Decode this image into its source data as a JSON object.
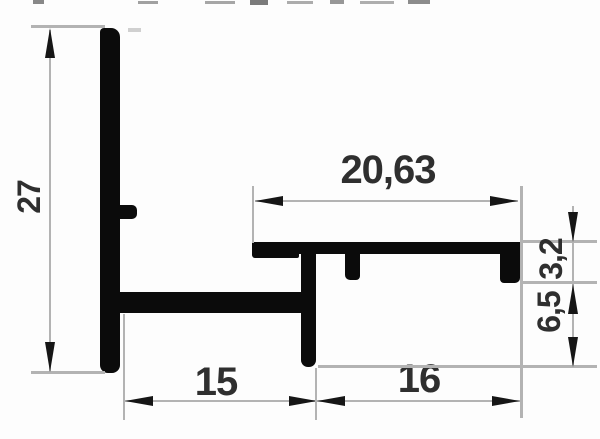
{
  "drawing": {
    "kind": "profile-cross-section-technical-drawing",
    "labels": {
      "height": "27",
      "top_width": "20,63",
      "flange_height": "3,2",
      "channel_depth": "6,5",
      "bottom_left_width": "15",
      "bottom_right_width": "16"
    },
    "colors": {
      "background": "#fdfdfd",
      "profile": "#0b0b0b",
      "dimension_line": "#b3b3b3",
      "arrow": "#161616",
      "text": "#2f2f2f"
    }
  }
}
